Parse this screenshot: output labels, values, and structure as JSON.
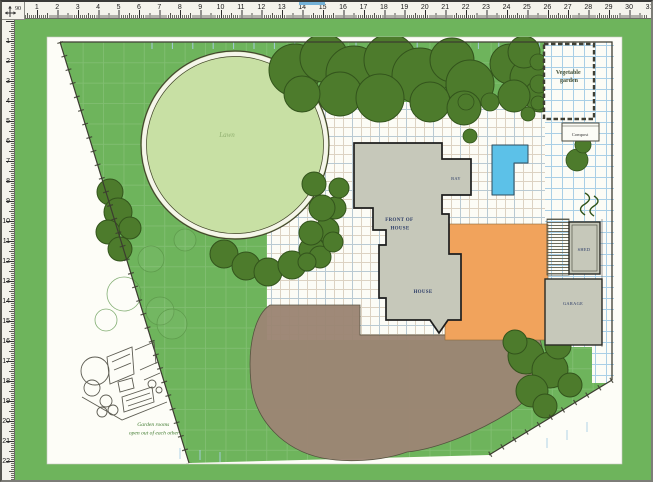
{
  "window": {
    "corner_label": "90"
  },
  "rulers": {
    "horizontal": {
      "numbers": [
        "1",
        "2",
        "3",
        "4",
        "5",
        "6",
        "7",
        "8",
        "9",
        "10",
        "11",
        "12",
        "13",
        "14",
        "15",
        "16",
        "17",
        "18",
        "19",
        "20",
        "21",
        "22",
        "23",
        "24",
        "25",
        "26",
        "27",
        "28",
        "29",
        "30",
        "31"
      ]
    },
    "vertical": {
      "numbers": [
        "1",
        "2",
        "3",
        "4",
        "5",
        "6",
        "7",
        "8",
        "9",
        "10",
        "11",
        "12",
        "13",
        "14",
        "15",
        "16",
        "17",
        "18",
        "19",
        "20",
        "21",
        "22"
      ]
    }
  },
  "colors": {
    "green": "#6eb45c",
    "page": "#fdfdf7",
    "lawn": "#c8e0a4",
    "tree": "#4d7b2c",
    "tree_dark": "#2f5318",
    "brown": "#9c8674",
    "orange": "#f1a35c",
    "pool": "#5cc1e8",
    "house": "#c6c8ba",
    "grid_blue": "#a9cfe6",
    "grid_blue_strong": "#9cc4e0",
    "grid_tan": "#dcd2c2",
    "navy": "#2a3a66",
    "caption": "#3f7a2f",
    "ruler": "#f4f3ec"
  },
  "plan": {
    "labels": {
      "lawn": "Lawn",
      "vegetable_garden_line1": "Vegetable",
      "vegetable_garden_line2": "garden",
      "compost": "Compost",
      "bay": "BAY",
      "front_of_house_line1": "FRONT OF",
      "front_of_house_line2": "HOUSE",
      "house": "HOUSE",
      "shed": "SHED",
      "garage": "GARAGE",
      "sketch_caption_line1": "Garden rooms",
      "sketch_caption_line2": "open out of each other"
    }
  }
}
